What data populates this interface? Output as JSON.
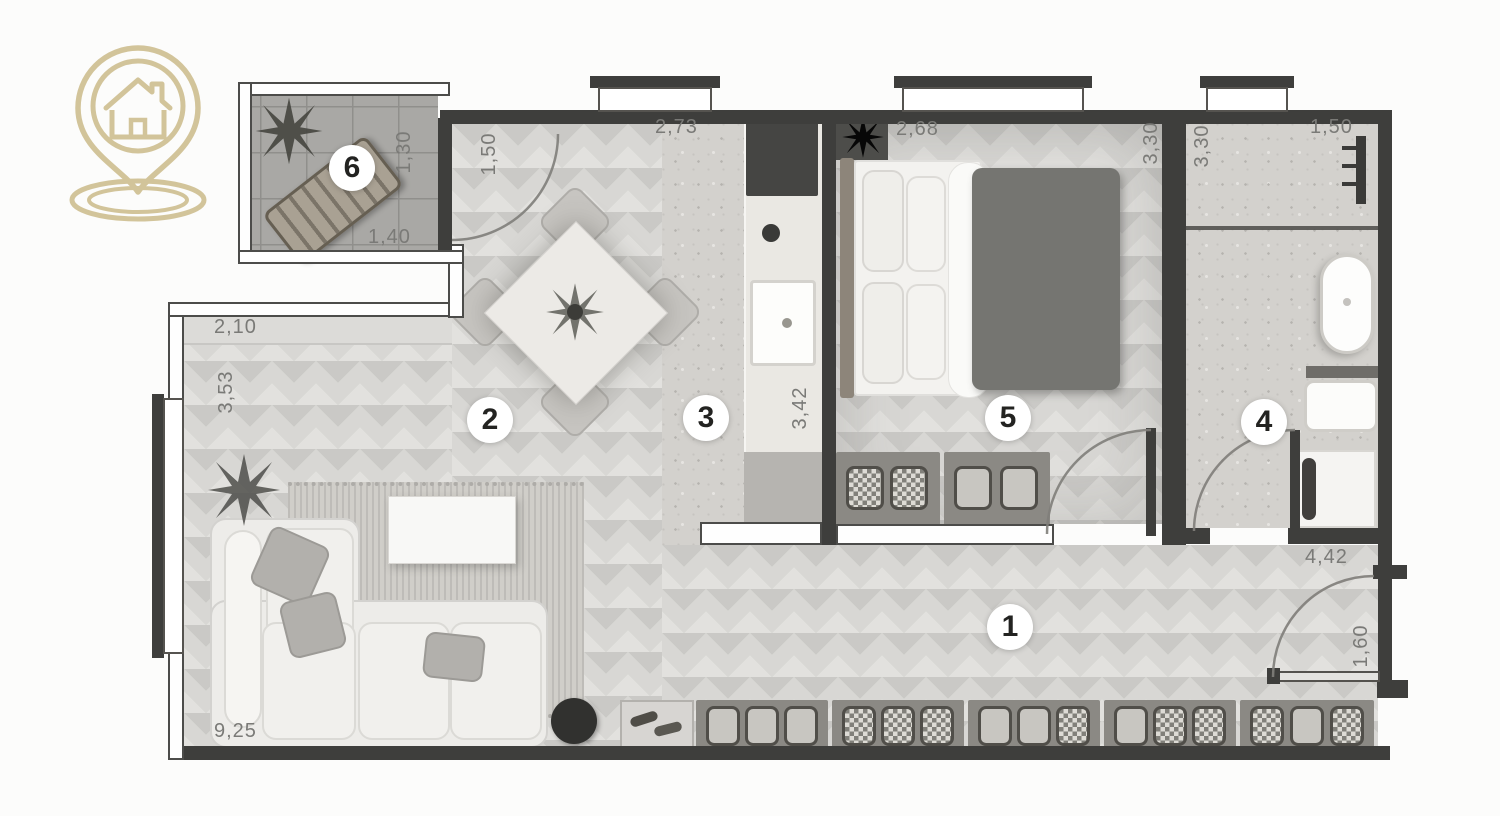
{
  "colors": {
    "background": "#fcfcfb",
    "wall": "#3e3e3c",
    "logo": "#d2c49a",
    "wood_floor": "#d8d7d4",
    "tile_floor": "#a9a8a5",
    "stone_floor": "#d3d1cd",
    "dimension_text": "#7a7a77",
    "room_number_text": "#232321",
    "duvet": "#757571"
  },
  "logo": {
    "icon": "house-location-pin"
  },
  "rooms": {
    "hallway": {
      "number": "1"
    },
    "living_dining": {
      "number": "2"
    },
    "kitchen": {
      "number": "3"
    },
    "bathroom": {
      "number": "4"
    },
    "bedroom": {
      "number": "5"
    },
    "balcony": {
      "number": "6"
    }
  },
  "dims": {
    "balcony_depth": "1,30",
    "balcony_width": "1,40",
    "living_entry_width": "1,50",
    "living_top_width": "2,10",
    "living_left_height": "3,53",
    "living_bottom_width": "9,25",
    "kitchen_top_width": "2,73",
    "kitchen_counter_height": "3,42",
    "bedroom_top_width": "2,68",
    "bedroom_right_height": "3,30",
    "bathroom_left_height": "3,30",
    "bathroom_top_width": "1,50",
    "hallway_width": "4,42",
    "entrance_width": "1,60"
  }
}
